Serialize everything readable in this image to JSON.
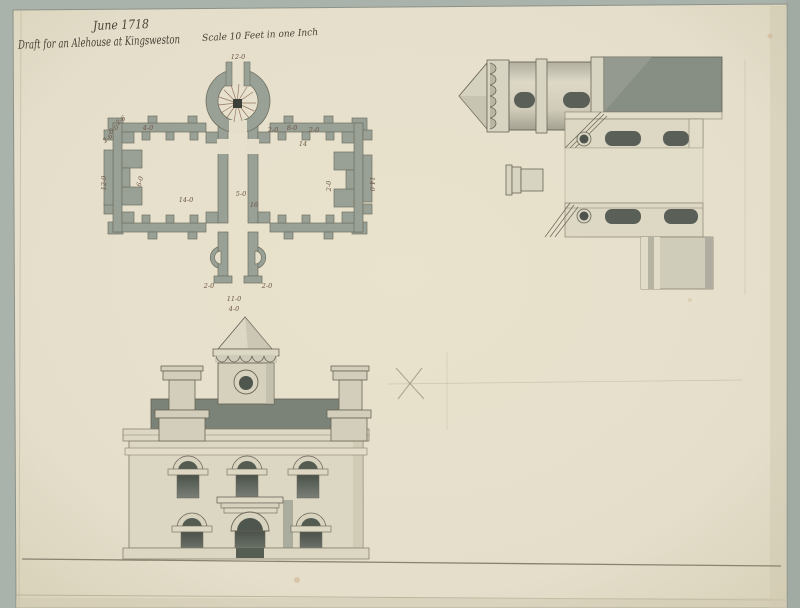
{
  "document": {
    "date_line": "June 1718",
    "title_line": "Draft for an Alehouse at Kingsweston",
    "scale_note": "Scale 10 Feet in one Inch"
  },
  "plan": {
    "labels": [
      {
        "text": "12-0",
        "x": 238,
        "y": 59
      },
      {
        "text": "2-6",
        "x": 122,
        "y": 122,
        "rot": -38
      },
      {
        "text": "6-0",
        "x": 115,
        "y": 131,
        "rot": -38
      },
      {
        "text": "2-6",
        "x": 109,
        "y": 140,
        "rot": -38
      },
      {
        "text": "4-0",
        "x": 148,
        "y": 130
      },
      {
        "text": "12-0",
        "x": 106,
        "y": 183,
        "rot": -90
      },
      {
        "text": "6-0",
        "x": 142,
        "y": 182,
        "rot": -75
      },
      {
        "text": "14-0",
        "x": 186,
        "y": 202
      },
      {
        "text": "5-0",
        "x": 241,
        "y": 196
      },
      {
        "text": "16",
        "x": 254,
        "y": 207
      },
      {
        "text": "14",
        "x": 303,
        "y": 146
      },
      {
        "text": "2-0",
        "x": 273,
        "y": 132
      },
      {
        "text": "8-0",
        "x": 292,
        "y": 130
      },
      {
        "text": "2-0",
        "x": 314,
        "y": 132
      },
      {
        "text": "2-0",
        "x": 331,
        "y": 186,
        "rot": -90
      },
      {
        "text": "14-0",
        "x": 370,
        "y": 184,
        "rot": 90
      },
      {
        "text": "2-0",
        "x": 209,
        "y": 288
      },
      {
        "text": "2-0",
        "x": 267,
        "y": 288
      },
      {
        "text": "11-0",
        "x": 234,
        "y": 301
      },
      {
        "text": "4-0",
        "x": 234,
        "y": 311
      }
    ]
  },
  "palette": {
    "mat": "#aab3ab",
    "paper": "#e5dfc9",
    "wall_wash": "#99a197",
    "roof_wash": "#7b8277",
    "opening_dark": "#525a50",
    "stone_light": "#d7d3c0",
    "ink": "#6b6557",
    "handwriting_ink": "#4a4236",
    "pencil": "#9a917e"
  }
}
